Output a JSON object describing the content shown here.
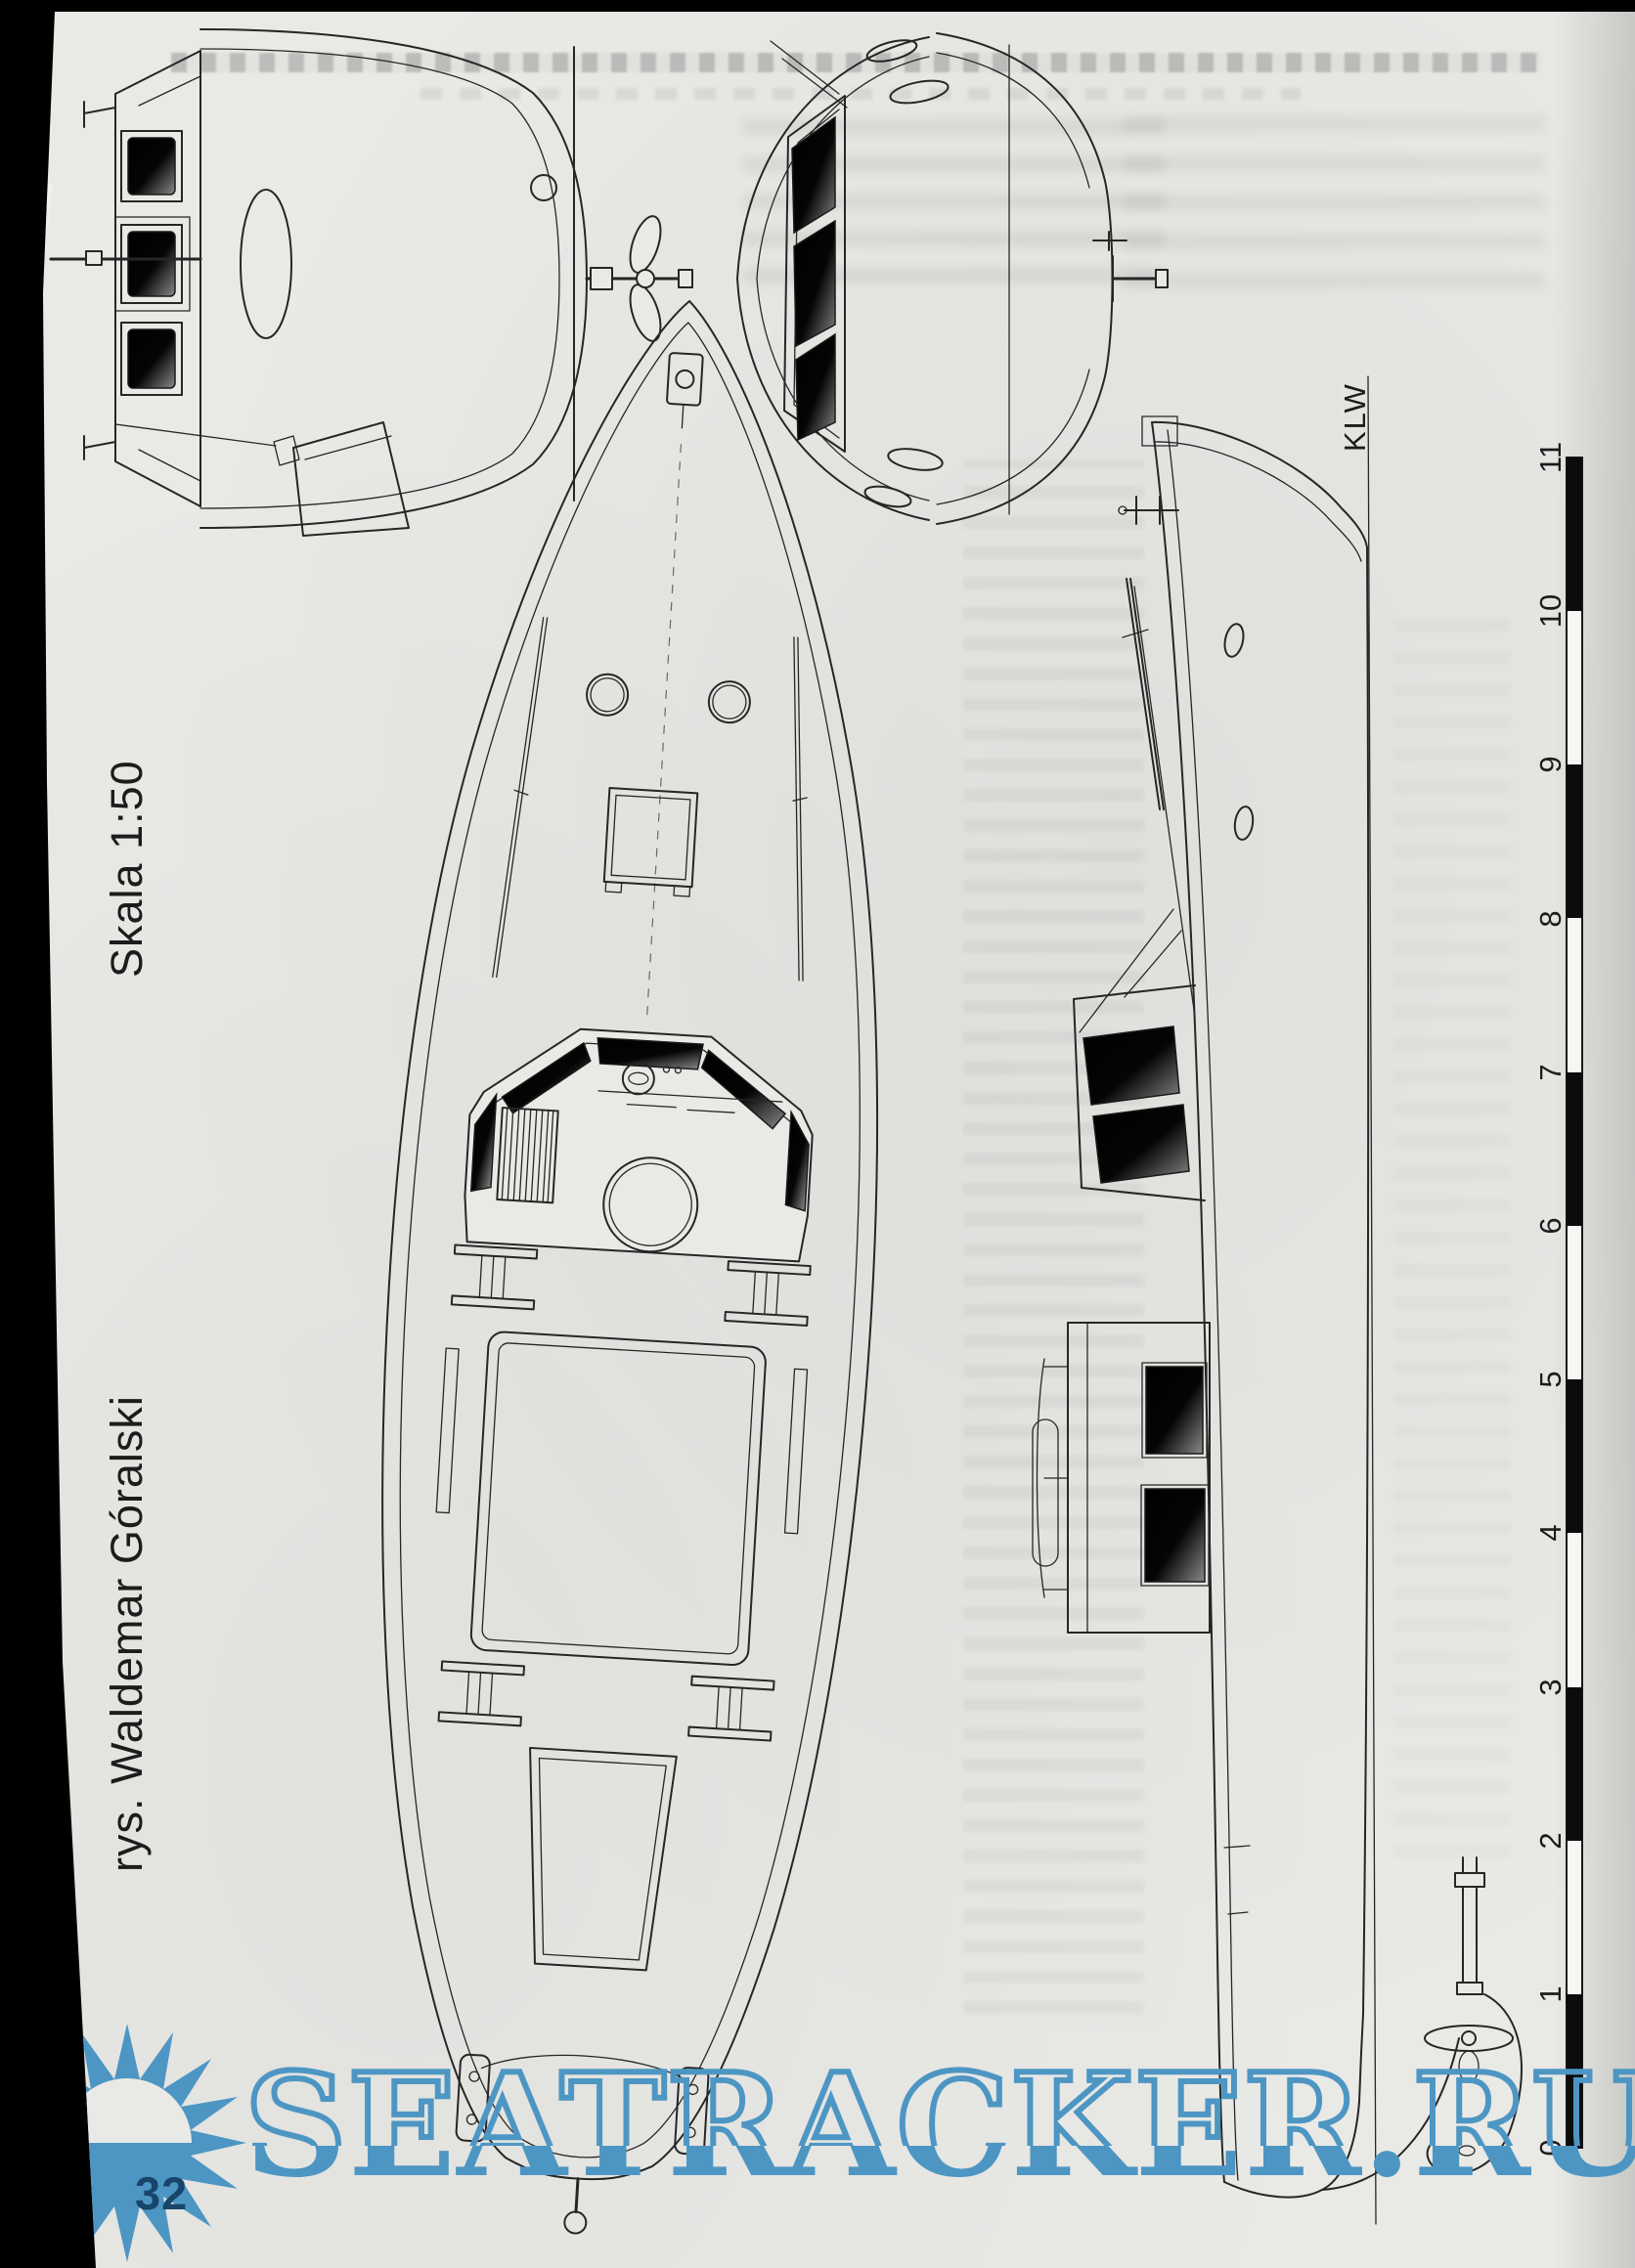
{
  "page": {
    "scale_label": "Skala 1:50",
    "artist_label": "rys. Waldemar Góralski",
    "waterline_label": "KLW",
    "page_number": "32"
  },
  "ruler": {
    "unit_labels": [
      "11",
      "10",
      "9",
      "8",
      "7",
      "6",
      "5",
      "4",
      "3",
      "2",
      "1",
      "0"
    ]
  },
  "watermark": {
    "text": "SEATRACKER.RU",
    "color": "#4d96c3",
    "page_number_color": "#17456b"
  },
  "colors": {
    "paper": "#e9e9e6",
    "ink": "#262626",
    "scan_border": "#000000"
  }
}
